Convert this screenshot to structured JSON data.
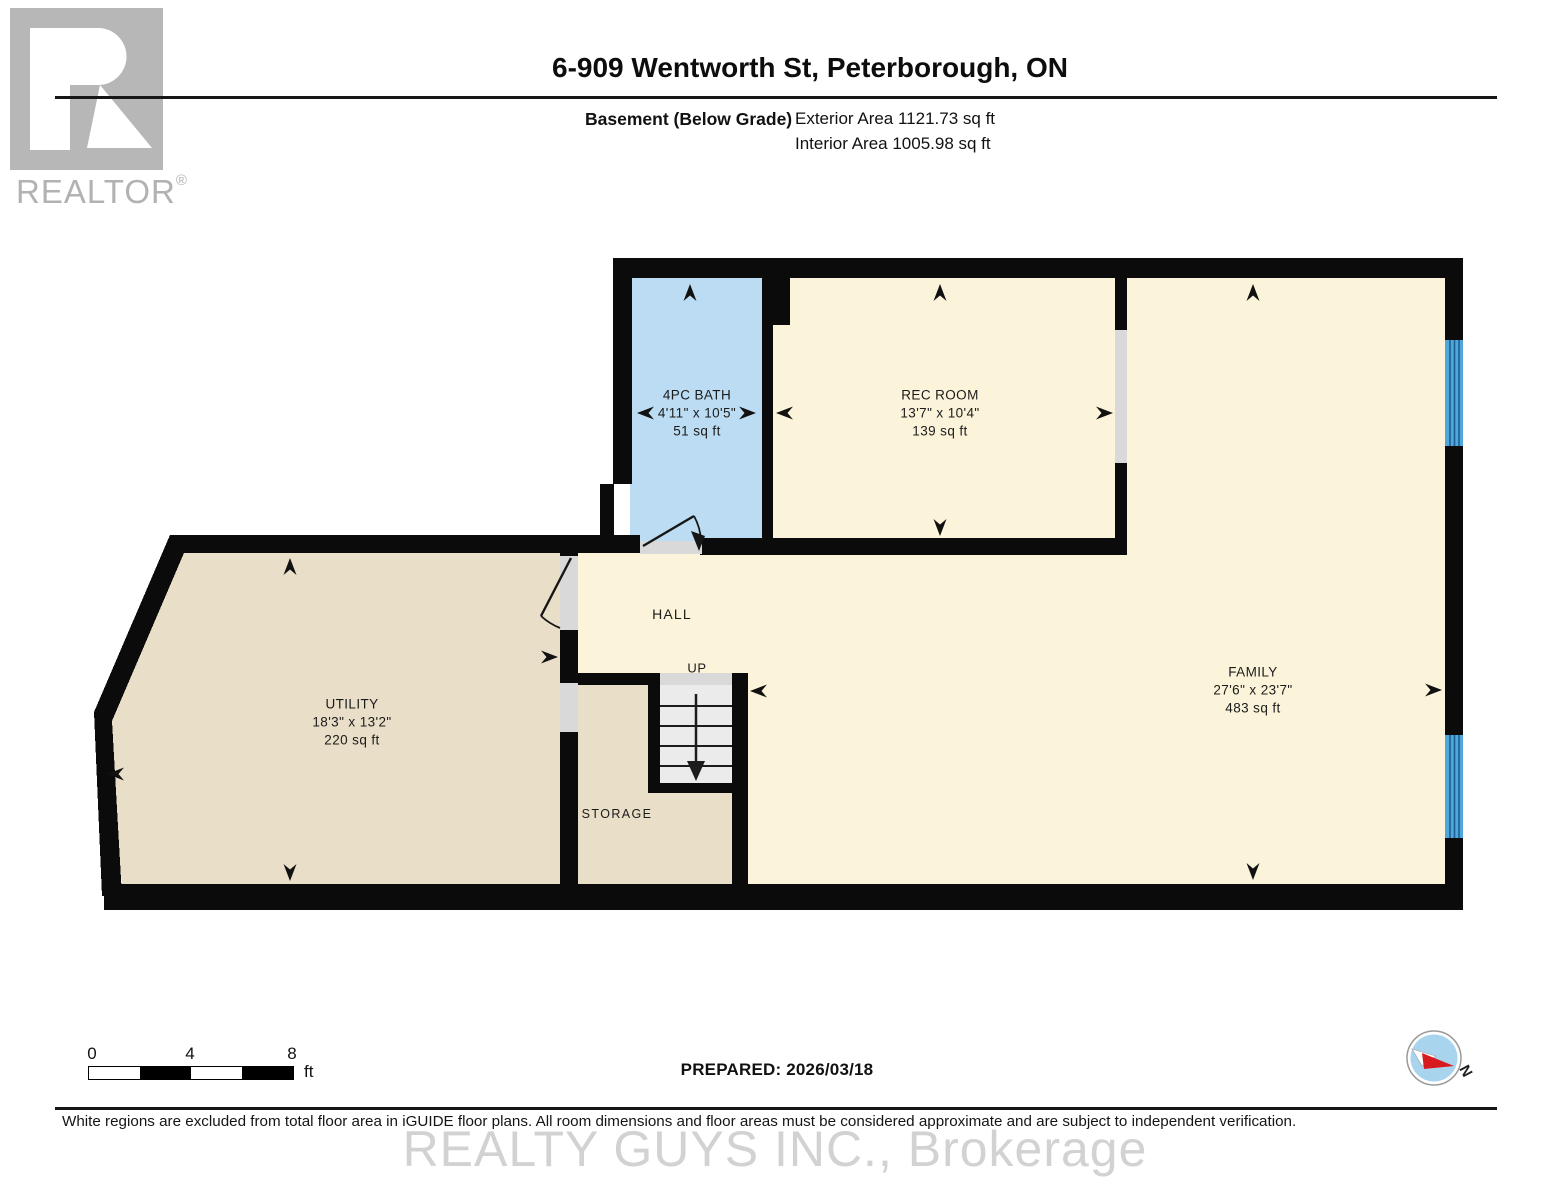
{
  "header": {
    "title": "6-909 Wentworth St, Peterborough, ON",
    "floor_label": "Basement (Below Grade)",
    "exterior_area": "Exterior Area 1121.73 sq ft",
    "interior_area": "Interior Area 1005.98 sq ft",
    "logo_brand": "REALTOR",
    "logo_registered": "®"
  },
  "rooms": [
    {
      "id": "bath",
      "name": "4PC BATH",
      "dims": "4'11\" x 10'5\"",
      "area": "51 sq ft"
    },
    {
      "id": "rec",
      "name": "REC ROOM",
      "dims": "13'7\" x 10'4\"",
      "area": "139 sq ft"
    },
    {
      "id": "family",
      "name": "FAMILY",
      "dims": "27'6\" x 23'7\"",
      "area": "483 sq ft"
    },
    {
      "id": "utility",
      "name": "UTILITY",
      "dims": "18'3\" x 13'2\"",
      "area": "220 sq ft"
    }
  ],
  "plan_labels": {
    "hall": "HALL",
    "up": "UP",
    "storage": "STORAGE"
  },
  "scale_bar": {
    "tick_0": "0",
    "tick_4": "4",
    "tick_8": "8",
    "unit": "ft"
  },
  "compass": {
    "north_label": "N"
  },
  "footer": {
    "prepared_label": "PREPARED: 2026/03/18",
    "disclaimer": "White regions are excluded from total floor area in iGUIDE floor plans. All room dimensions and floor areas must be considered approximate and are subject to independent verification.",
    "watermark": "REALTY GUYS INC., Brokerage"
  },
  "colors": {
    "wall": "#0b0b0b",
    "room_cream": "#fbf4da",
    "room_tan": "#e9dec7",
    "bath_blue": "#bcdcf3",
    "window_blue": "#4fa7dc",
    "opening_gray": "#d9d9d9",
    "stair_gray": "#ebebeb",
    "logo_gray": "#b7b7b7",
    "compass_blue": "#a9d4ee",
    "compass_red": "#d71920",
    "watermark_gray": "#d2d2d2"
  }
}
